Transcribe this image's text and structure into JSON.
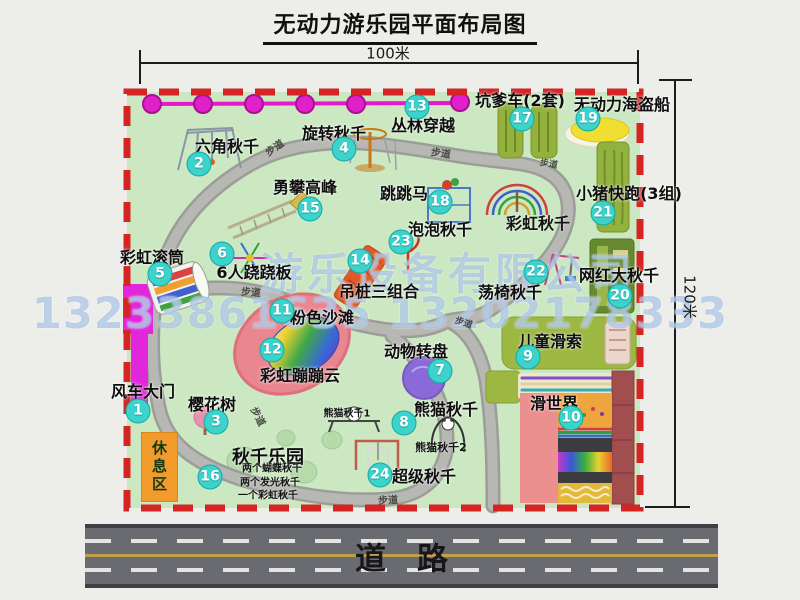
{
  "title": "无动力游乐园平面布局图",
  "dims": {
    "width": "100米",
    "height": "120米"
  },
  "road": {
    "label": "道　路"
  },
  "rest_area": "休息区",
  "walkway_label": "步道",
  "watermark": {
    "line1": "游乐设备有限公司",
    "line2": "13233861635 13202178333"
  },
  "attractions": [
    {
      "num": 1,
      "label": "风车大门",
      "bx": 138,
      "by": 411,
      "lx": 143,
      "ly": 390
    },
    {
      "num": 2,
      "label": "六角秋千",
      "bx": 199,
      "by": 164,
      "lx": 227,
      "ly": 145
    },
    {
      "num": 3,
      "label": "樱花树",
      "bx": 216,
      "by": 422,
      "lx": 212,
      "ly": 403
    },
    {
      "num": 4,
      "label": "旋转秋千",
      "bx": 344,
      "by": 149,
      "lx": 334,
      "ly": 132
    },
    {
      "num": 5,
      "label": "彩虹滚筒",
      "bx": 160,
      "by": 274,
      "lx": 152,
      "ly": 256
    },
    {
      "num": 6,
      "label": "6人跷跷板",
      "bx": 222,
      "by": 254,
      "lx": 254,
      "ly": 271
    },
    {
      "num": 7,
      "label": "动物转盘",
      "bx": 440,
      "by": 371,
      "lx": 416,
      "ly": 350
    },
    {
      "num": 8,
      "label": "熊猫秋千",
      "bx": 404,
      "by": 423,
      "lx": 446,
      "ly": 408
    },
    {
      "num": 9,
      "label": "儿童滑索",
      "bx": 528,
      "by": 357,
      "lx": 550,
      "ly": 340
    },
    {
      "num": 10,
      "label": "滑世界",
      "bx": 571,
      "by": 418,
      "lx": 554,
      "ly": 402
    },
    {
      "num": 11,
      "label": "粉色沙滩",
      "bx": 282,
      "by": 311,
      "lx": 322,
      "ly": 316
    },
    {
      "num": 12,
      "label": "彩虹蹦蹦云",
      "bx": 272,
      "by": 350,
      "lx": 300,
      "ly": 374
    },
    {
      "num": 13,
      "label": "丛林穿越",
      "bx": 417,
      "by": 107,
      "lx": 423,
      "ly": 124
    },
    {
      "num": 14,
      "label": "吊桩三组合",
      "bx": 360,
      "by": 261,
      "lx": 379,
      "ly": 290
    },
    {
      "num": 15,
      "label": "勇攀高峰",
      "bx": 310,
      "by": 209,
      "lx": 305,
      "ly": 186
    },
    {
      "num": 16,
      "label": "秋千乐园",
      "bx": 210,
      "by": 477,
      "lx": 268,
      "ly": 456,
      "fs": 18
    },
    {
      "num": 17,
      "label": "坑爹车(2套)",
      "bx": 522,
      "by": 119,
      "lx": 520,
      "ly": 99
    },
    {
      "num": 18,
      "label": "跳跳马",
      "bx": 440,
      "by": 202,
      "lx": 404,
      "ly": 192
    },
    {
      "num": 19,
      "label": "无动力海盗船",
      "bx": 588,
      "by": 119,
      "lx": 622,
      "ly": 103
    },
    {
      "num": 20,
      "label": "网红大秋千",
      "bx": 620,
      "by": 296,
      "lx": 619,
      "ly": 274
    },
    {
      "num": 21,
      "label": "小猪快跑(3组)",
      "bx": 603,
      "by": 213,
      "lx": 629,
      "ly": 192
    },
    {
      "num": 22,
      "label": "荡椅秋千",
      "bx": 536,
      "by": 272,
      "lx": 510,
      "ly": 291
    },
    {
      "num": 23,
      "label": "泡泡秋千",
      "bx": 401,
      "by": 242,
      "lx": 440,
      "ly": 228
    },
    {
      "num": 24,
      "label": "超级秋千",
      "bx": 380,
      "by": 475,
      "lx": 424,
      "ly": 475
    }
  ],
  "extra_labels": [
    {
      "text": "彩虹秋千",
      "x": 538,
      "y": 222,
      "fs": 16
    },
    {
      "text": "熊猫秋千1",
      "x": 347,
      "y": 412,
      "fs": 10
    },
    {
      "text": "熊猫秋千2",
      "x": 441,
      "y": 447,
      "fs": 11
    },
    {
      "text": "两个蝴蝶秋千",
      "x": 272,
      "y": 467,
      "fs": 10
    },
    {
      "text": "两个发光秋千",
      "x": 270,
      "y": 481,
      "fs": 10
    },
    {
      "text": "一个彩虹秋千",
      "x": 268,
      "y": 494,
      "fs": 10
    }
  ],
  "walkways": [
    {
      "x": 274,
      "y": 147,
      "rot": -35
    },
    {
      "x": 441,
      "y": 152,
      "rot": 8
    },
    {
      "x": 549,
      "y": 163,
      "rot": 10,
      "fs": 9
    },
    {
      "x": 251,
      "y": 291,
      "rot": 4
    },
    {
      "x": 464,
      "y": 322,
      "rot": 18,
      "fs": 9
    },
    {
      "x": 259,
      "y": 416,
      "rot": 62
    },
    {
      "x": 388,
      "y": 499,
      "rot": -3
    }
  ],
  "colors": {
    "map_green": "#cbe8c2",
    "border_red": "#d42424",
    "badge_cyan": "#3bd3cc",
    "rope_magenta": "#e818c8",
    "gate_magenta": "#e226dc",
    "rest_orange": "#f29b2d",
    "road_gray": "#6a6a71",
    "path_gray": "#b4b5b0",
    "beach_pink": "#e9868f",
    "equip_olive": "#95b13d",
    "slide_salmon": "#ec8f8f",
    "slide_maroon": "#a34e4e"
  }
}
